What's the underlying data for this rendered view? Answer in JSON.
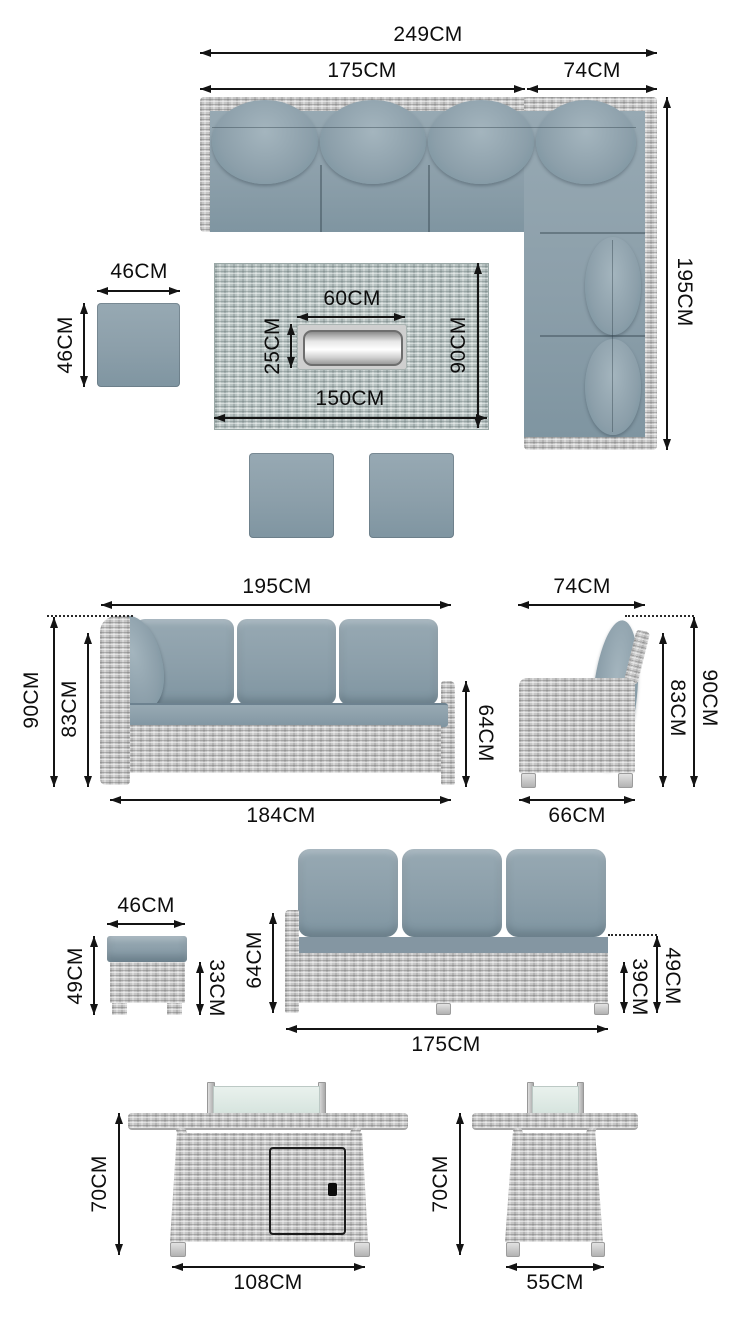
{
  "colors": {
    "background": "#ffffff",
    "dimension_line": "#141414",
    "cushion_blue_grey": "#8c9faa",
    "wicker_grey": "#c6c6c6",
    "table_wicker_teal": "#b7c2c1",
    "glass_screen": "#dfeae5",
    "firepit_frame": "#cfcfcf"
  },
  "plan_view": {
    "dims": {
      "total_width": "249CM",
      "left_section": "175CM",
      "corner_section": "74CM",
      "depth": "195CM",
      "stool_width": "46CM",
      "stool_depth": "46CM",
      "firepit_width": "60CM",
      "firepit_depth": "25CM",
      "table_depth": "90CM",
      "table_width": "150CM"
    }
  },
  "sofa_front_view": {
    "dims": {
      "width": "195CM",
      "total_height": "90CM",
      "back_height": "83CM",
      "seat_back_height": "64CM",
      "base_width": "184CM"
    }
  },
  "sofa_side_view": {
    "dims": {
      "width": "74CM",
      "back_height": "83CM",
      "total_height": "90CM",
      "base_width": "66CM"
    }
  },
  "stool_view": {
    "dims": {
      "width": "46CM",
      "total_height": "49CM",
      "base_height": "33CM"
    }
  },
  "sofa_back_view": {
    "dims": {
      "arm_height": "64CM",
      "base_height": "39CM",
      "seat_height": "49CM",
      "width": "175CM"
    }
  },
  "table_front_view": {
    "dims": {
      "height": "70CM",
      "width": "108CM"
    }
  },
  "table_side_view": {
    "dims": {
      "height": "70CM",
      "width": "55CM"
    }
  }
}
